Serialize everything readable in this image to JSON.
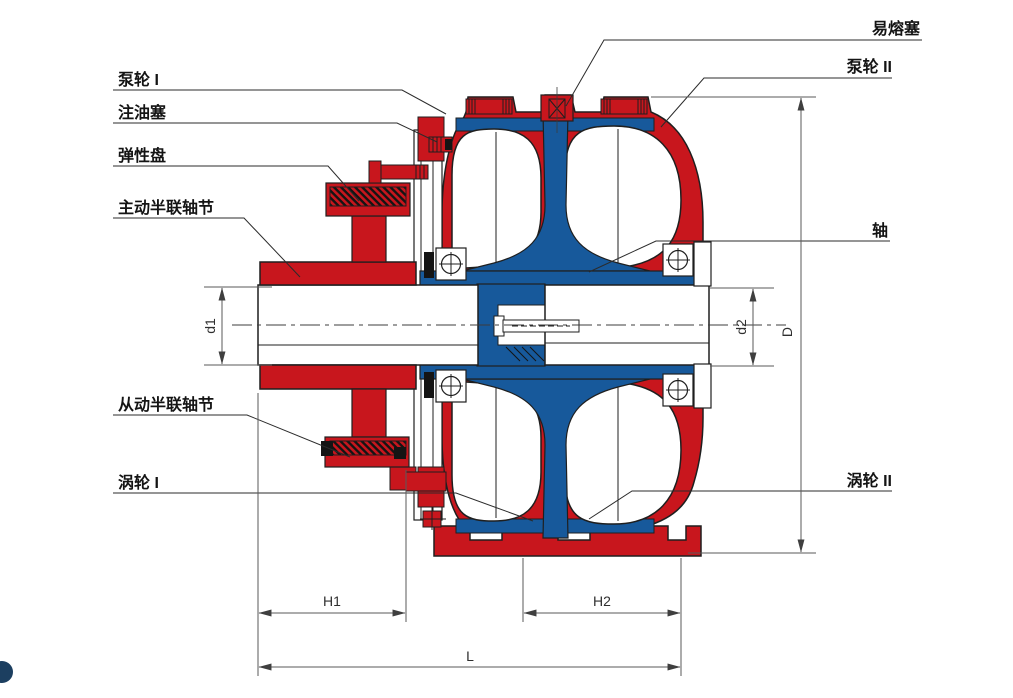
{
  "diagram": {
    "type": "technical-cross-section",
    "subject": "fluid coupling (液力偶合器) sectional drawing",
    "colors": {
      "red": "#C8161D",
      "blue": "#17599B",
      "outline": "#1F1F1F",
      "dim_line": "#5A5A5A",
      "label_text": "#141414",
      "page_dot": "#1C3F60"
    },
    "labels": {
      "pump_wheel_1": "泵轮 I",
      "oil_fill_plug": "注油塞",
      "elastic_disc": "弹性盘",
      "driving_half_coupling": "主动半联轴节",
      "driven_half_coupling": "从动半联轴节",
      "turbine_1": "涡轮 I",
      "fusible_plug": "易熔塞",
      "pump_wheel_2": "泵轮 II",
      "shaft": "轴",
      "turbine_2": "涡轮 II"
    },
    "dimensions": {
      "d1": "d1",
      "d2": "d2",
      "D": "D",
      "H1": "H1",
      "H2": "H2",
      "L": "L"
    }
  }
}
